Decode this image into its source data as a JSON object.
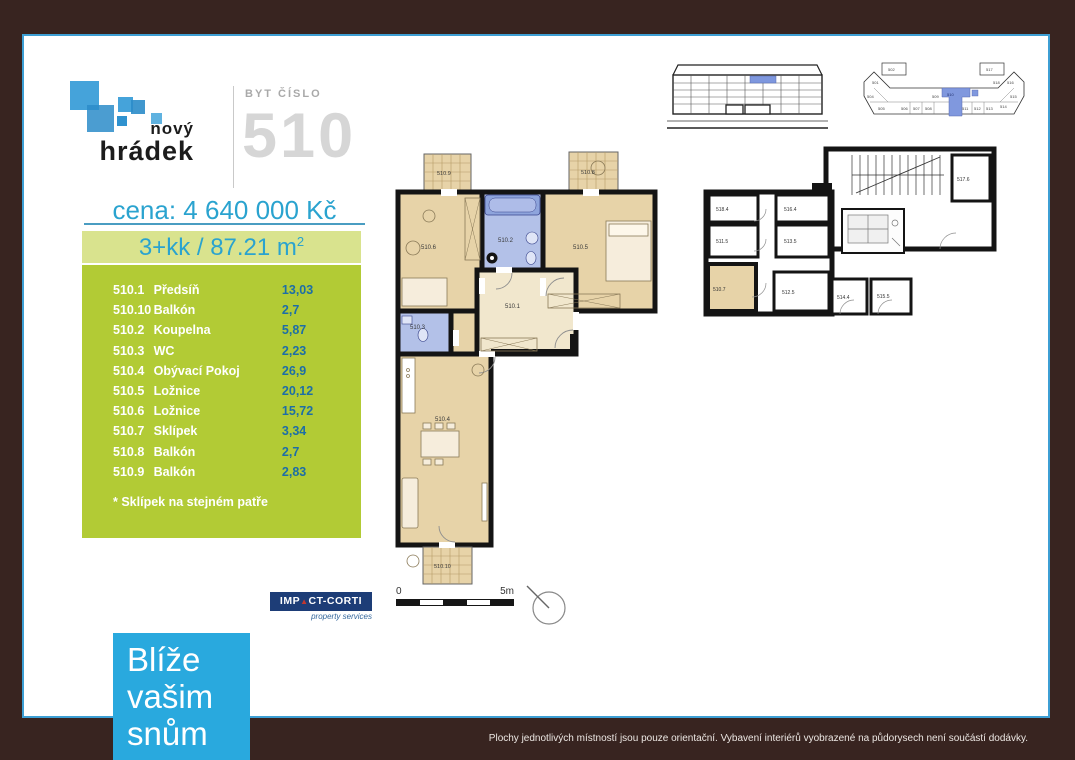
{
  "brand": {
    "top": "nový",
    "bottom": "hrádek"
  },
  "header": {
    "label": "BYT ČÍSLO",
    "number": "510"
  },
  "price": "cena: 4 640 000 Kč",
  "summary": {
    "text": "3+kk / 87.21 m",
    "sup": "2"
  },
  "room_table": {
    "rows": [
      {
        "code": "510.1",
        "name": "Předsíň",
        "area": "13,03"
      },
      {
        "code": "510.10",
        "name": "Balkón",
        "area": "2,7"
      },
      {
        "code": "510.2",
        "name": "Koupelna",
        "area": "5,87"
      },
      {
        "code": "510.3",
        "name": "WC",
        "area": "2,23"
      },
      {
        "code": "510.4",
        "name": "Obývací Pokoj",
        "area": "26,9"
      },
      {
        "code": "510.5",
        "name": "Ložnice",
        "area": "20,12"
      },
      {
        "code": "510.6",
        "name": "Ložnice",
        "area": "15,72"
      },
      {
        "code": "510.7",
        "name": "Sklípek",
        "area": "3,34"
      },
      {
        "code": "510.8",
        "name": "Balkón",
        "area": "2,7"
      },
      {
        "code": "510.9",
        "name": "Balkón",
        "area": "2,83"
      }
    ],
    "footnote": "* Sklípek na stejném patře"
  },
  "plans": {
    "main": {
      "hallway": "510.1",
      "bathroom": "510.2",
      "wc": "510.3",
      "living_room": "510.4",
      "bedroom1": "510.5",
      "bedroom2": "510.6",
      "balcony8": "510.8",
      "balcony9": "510.9",
      "balcony10": "510.10"
    },
    "cellar": {
      "r1": "518.4",
      "r2": "516.4",
      "r3": "511.5",
      "r4": "513.5",
      "sklipek": "510.7",
      "r5": "512.5",
      "r6": "514.4",
      "r7": "515.5",
      "r8": "517.6"
    },
    "overview_units": [
      "502",
      "501",
      "504",
      "505",
      "506",
      "507",
      "508",
      "509",
      "510",
      "511",
      "512",
      "513",
      "514",
      "515",
      "516",
      "517",
      "518"
    ]
  },
  "scale": {
    "start": "0",
    "end": "5m"
  },
  "partner": {
    "part1": "IMP",
    "triangle": "▲",
    "part2": "CT-CORTI",
    "sub": "property services"
  },
  "tagline": {
    "line1": "Blíže",
    "line2": "vašim",
    "line3": "snům"
  },
  "disclaimer": "Plochy jednotlivých místností jsou pouze orientační. Vybavení interiérů vyobrazené na půdorysech není součástí dodávky.",
  "colors": {
    "accent_blue": "#2aa3cf",
    "table_green": "#b2cb35",
    "band_green": "#d9e38e",
    "tagline_blue": "#29a9de",
    "frame_brown": "#382420",
    "unit_highlight": "#7e97de",
    "room_tan": "#e7d3a8",
    "wet_room_blue": "#b3c1e8",
    "partner_navy": "#1d3d77"
  }
}
